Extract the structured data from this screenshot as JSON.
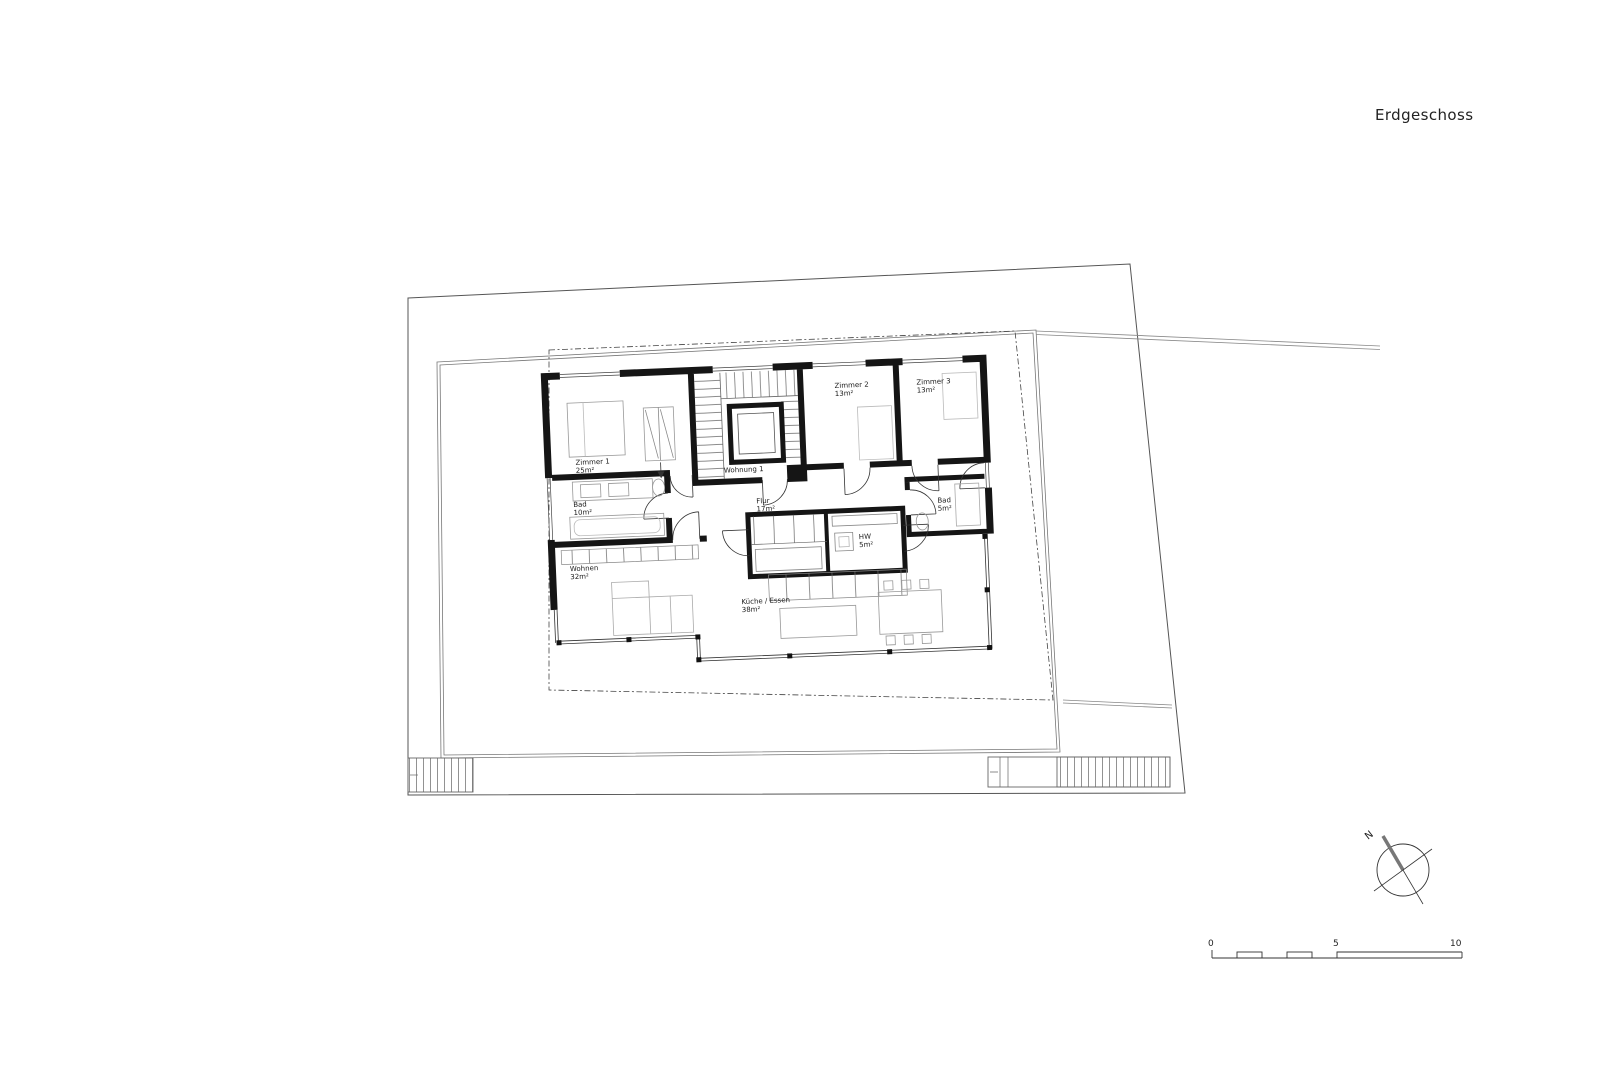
{
  "title": "Erdgeschoss",
  "plan": {
    "unit_label": "Wohnung 1",
    "rooms": [
      {
        "name": "Zimmer 1",
        "area": "25m²"
      },
      {
        "name": "Bad",
        "area": "10m²"
      },
      {
        "name": "Wohnen",
        "area": "32m²"
      },
      {
        "name": "Flur",
        "area": "17m²"
      },
      {
        "name": "HW",
        "area": "5m²"
      },
      {
        "name": "Küche / Essen",
        "area": "38m²"
      },
      {
        "name": "Zimmer 2",
        "area": "13m²"
      },
      {
        "name": "Zimmer 3",
        "area": "13m²"
      },
      {
        "name": "Bad",
        "area": "5m²"
      }
    ]
  },
  "compass": {
    "north_label": "N"
  },
  "scale_bar": {
    "labels": [
      "0",
      "5",
      "10"
    ]
  }
}
